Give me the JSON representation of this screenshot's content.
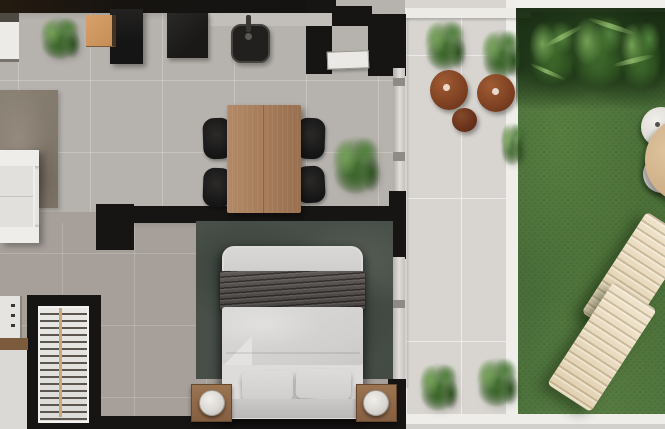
{
  "scene": {
    "title": "Top-down 3D apartment floor plan render with patio and garden",
    "rooms": {
      "living": {
        "label": "Living room",
        "furniture": [
          "white sofa",
          "brown area rug",
          "white sideboard",
          "green plant",
          "orange wood stool"
        ]
      },
      "kitchen": {
        "label": "Kitchen",
        "furniture": [
          "black tall cabinet",
          "black cooktop",
          "black sink with faucet",
          "counter"
        ]
      },
      "dining": {
        "label": "Dining area",
        "furniture": [
          "wood dining table",
          "four black chairs",
          "potted plant"
        ]
      },
      "entry": {
        "label": "Entry",
        "furniture": [
          "white entry door",
          "black partition walls"
        ]
      },
      "bedroom": {
        "label": "Bedroom",
        "furniture": [
          "double bed with dark throw blanket",
          "two pillows",
          "two wood nightstands",
          "two round lamps",
          "dark mottled rug"
        ]
      },
      "closet": {
        "label": "Closet and laundry nook",
        "furniture": [
          "white slatted shelving unit",
          "white appliance",
          "wood counter strip"
        ]
      },
      "patio": {
        "label": "Patio terrace",
        "furniture": [
          "two potted palms",
          "three terracotta pots",
          "two green bushes",
          "sliding glass doors"
        ]
      },
      "garden": {
        "label": "Garden lawn",
        "furniture": [
          "two cream sun loungers",
          "round outdoor table",
          "two round white chairs",
          "tropical hedge"
        ]
      }
    },
    "palette": {
      "wall": "#171514",
      "floor_interior": "#b5b1ab",
      "floor_bedroom": "#a7a09a",
      "floor_patio": "#d8d5d0",
      "curb_white": "#efeeea",
      "rug_living": "#867c70",
      "rug_bedroom": "#4a514b",
      "table_wood": "#a87e5c",
      "nightstand_wood": "#8d6848",
      "grass": "#507540",
      "foliage_dark": "#24401c",
      "terracotta": "#84492a",
      "lounger_cream": "#e9ddc4",
      "linen_white": "#dedcda",
      "blanket_gray": "#524d4b",
      "black_furniture": "#1d1c1b",
      "stool_orange": "#d09a62"
    }
  }
}
